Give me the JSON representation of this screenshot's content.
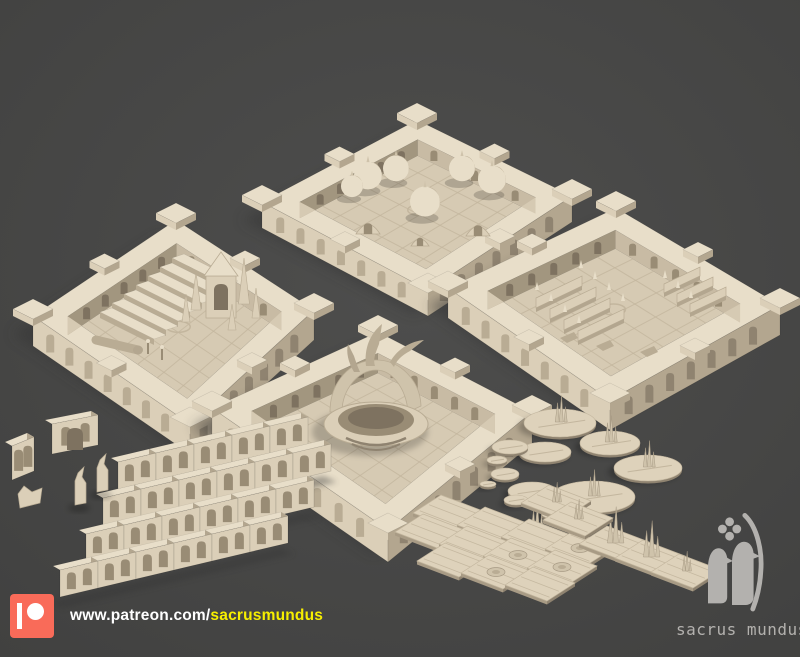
{
  "footer": {
    "url_prefix": "www.patreon.com/",
    "url_user": "sacrusmundus"
  },
  "brand": {
    "name": "sacrus mundus"
  },
  "scene": {
    "items": [
      "domed-shrine-room",
      "chapel-pew-room",
      "grand-staircase-room",
      "fountain-room",
      "modular-wall-segments",
      "gateway-piece",
      "broken-columns",
      "scatter-bases",
      "floor-tiles"
    ]
  },
  "colors": {
    "bgCenter": "#4e4e4d",
    "bgEdge": "#414140",
    "shadow": "#343434",
    "top": "#e8dec9",
    "wallLight": "#dbcfb8",
    "wallShade": "#b3a68f",
    "recess": "#998c75",
    "recessDark": "#7e7260",
    "archLight": "#b9ac94",
    "archDark": "#8f8370",
    "floor": "#d6cab3",
    "floorLine": "#c3b69e",
    "innerLeft": "#a2967f",
    "innerRight": "#c8bba4",
    "plateTop": "#ded2bb",
    "plateSide": "#a89b85",
    "spike": "#cfc3ab",
    "patreonRed": "#f96b59",
    "urlWhite": "#ffffff",
    "urlYellow": "#f6ee00",
    "logoGray": "#b3b1ae"
  }
}
